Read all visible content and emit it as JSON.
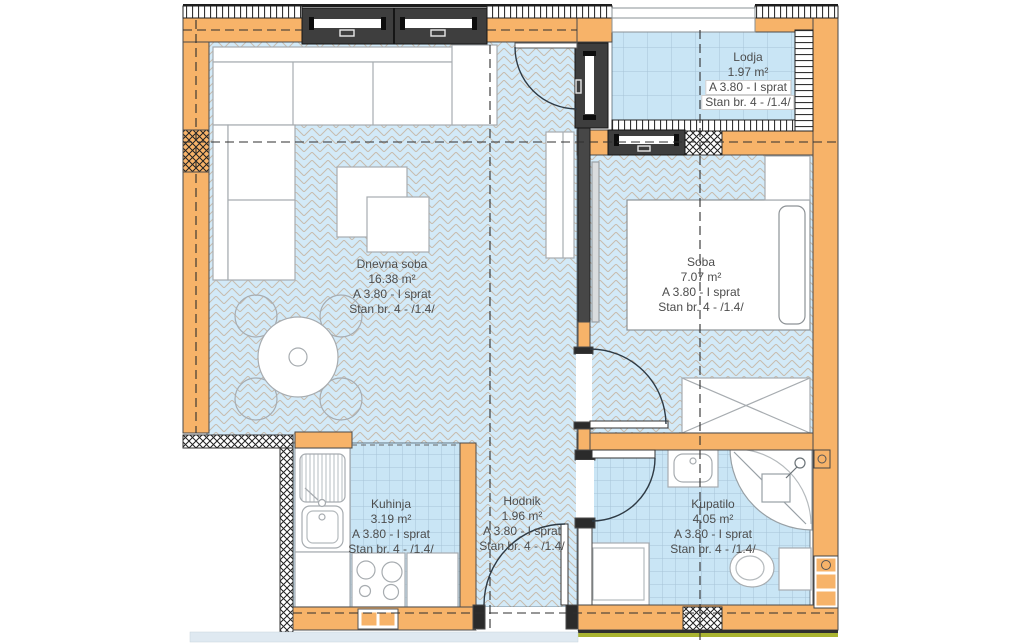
{
  "rooms": [
    {
      "key": "dnevna-soba",
      "name": "Dnevna soba",
      "area": "16.38 m²",
      "floor_line": "A 3.80 - I sprat",
      "unit_line": "Stan br. 4 - /1.4/"
    },
    {
      "key": "soba",
      "name": "Soba",
      "area": "7.07 m²",
      "floor_line": "A 3.80 - I sprat",
      "unit_line": "Stan br. 4 - /1.4/"
    },
    {
      "key": "lodja",
      "name": "Lodja",
      "area": "1.97 m²",
      "floor_line": "A 3.80 - I sprat",
      "unit_line": "Stan br. 4 - /1.4/"
    },
    {
      "key": "kuhinja",
      "name": "Kuhinja",
      "area": "3.19 m²",
      "floor_line": "A 3.80 - I sprat",
      "unit_line": "Stan br. 4 - /1.4/"
    },
    {
      "key": "hodnik",
      "name": "Hodnik",
      "area": "1.96 m²",
      "floor_line": "A 3.80 - I sprat",
      "unit_line": "Stan br. 4 - /1.4/"
    },
    {
      "key": "kupatilo",
      "name": "Kupatilo",
      "area": "4.05 m²",
      "floor_line": "A 3.80 - I sprat",
      "unit_line": "Stan br. 4 - /1.4/"
    }
  ],
  "colors": {
    "wall_fill": "#f7b369",
    "floor_fill": "#cfe7f5",
    "window_frame": "#3e3e3e",
    "label_text": "#4d4d4d",
    "grass_line": "#a9b330",
    "herringbone_line": "#c7bcae",
    "tile_line": "#a6c3d6"
  }
}
